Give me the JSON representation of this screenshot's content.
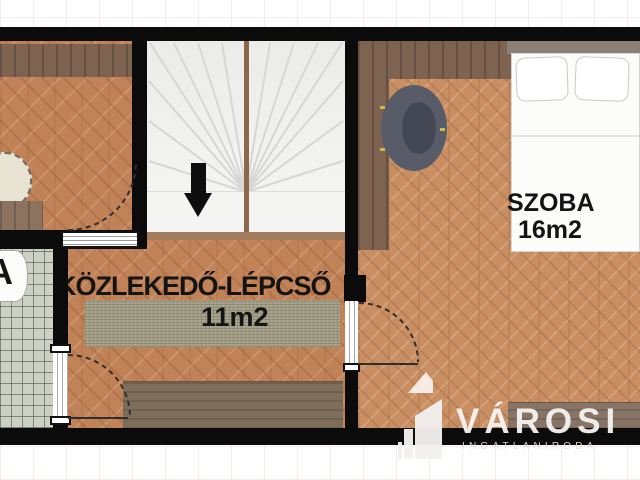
{
  "document": {
    "type": "floor-plan"
  },
  "rooms": {
    "corridor": {
      "name": "KÖZLEKEDŐ-LÉPCSŐ",
      "area": "11m2"
    },
    "bedroom": {
      "name": "SZOBA",
      "area": "16m2"
    },
    "bathroom": {
      "name_partial": "A"
    }
  },
  "stairs": {
    "direction": "down"
  },
  "watermark": {
    "brand": "VÁROSI",
    "subtitle": "INGATLANIRODA"
  },
  "colors": {
    "wall": "#0b0b0b",
    "wood_floor": "#c18257",
    "bedroom_floor": "#c98f63",
    "dark_wood": "#7d6350",
    "tile": "#cdd1c5",
    "rug": "#a7a38d",
    "armchair": "#575c68",
    "watermark_text": "#f1f0ee"
  }
}
